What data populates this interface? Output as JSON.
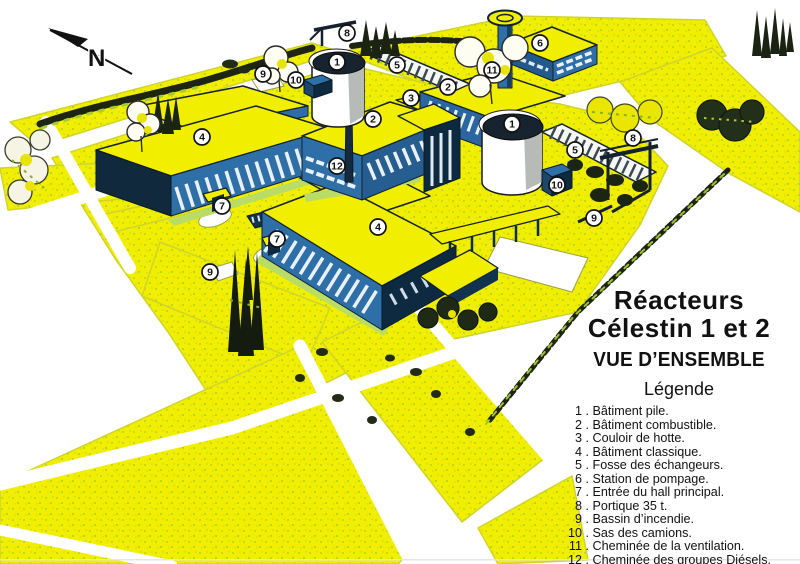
{
  "north": {
    "label": "N"
  },
  "title": {
    "line1": "Réacteurs",
    "line2": "Célestin 1 et 2",
    "subtitle": "VUE D’ENSEMBLE"
  },
  "legend": {
    "heading": "Légende",
    "separator": " . ",
    "items": [
      {
        "n": "1",
        "label": "Bâtiment pile."
      },
      {
        "n": "2",
        "label": "Bâtiment combustible."
      },
      {
        "n": "3",
        "label": "Couloir de hotte."
      },
      {
        "n": "4",
        "label": "Bâtiment classique."
      },
      {
        "n": "5",
        "label": "Fosse des échangeurs."
      },
      {
        "n": "6",
        "label": "Station de pompage."
      },
      {
        "n": "7",
        "label": "Entrée du hall principal."
      },
      {
        "n": "8",
        "label": "Portique 35 t."
      },
      {
        "n": "9",
        "label": "Bassin d’incendie."
      },
      {
        "n": "10",
        "label": "Sas des camions."
      },
      {
        "n": "11",
        "label": "Cheminée de la ventilation."
      },
      {
        "n": "12",
        "label": "Cheminée des groupes Diésels."
      }
    ]
  },
  "markers": {
    "style": {
      "fill": "#ffffff",
      "stroke": "#111111",
      "text": "#111111",
      "radius": 8
    },
    "points": [
      {
        "n": "1",
        "x": 337,
        "y": 62
      },
      {
        "n": "1",
        "x": 512,
        "y": 124
      },
      {
        "n": "2",
        "x": 448,
        "y": 87
      },
      {
        "n": "2",
        "x": 373,
        "y": 119
      },
      {
        "n": "3",
        "x": 411,
        "y": 98
      },
      {
        "n": "4",
        "x": 202,
        "y": 137
      },
      {
        "n": "4",
        "x": 378,
        "y": 227
      },
      {
        "n": "5",
        "x": 397,
        "y": 65
      },
      {
        "n": "5",
        "x": 575,
        "y": 150
      },
      {
        "n": "6",
        "x": 540,
        "y": 43
      },
      {
        "n": "7",
        "x": 222,
        "y": 206
      },
      {
        "n": "7",
        "x": 277,
        "y": 239
      },
      {
        "n": "8",
        "x": 347,
        "y": 33
      },
      {
        "n": "8",
        "x": 633,
        "y": 138
      },
      {
        "n": "9",
        "x": 263,
        "y": 74
      },
      {
        "n": "9",
        "x": 210,
        "y": 272
      },
      {
        "n": "9",
        "x": 594,
        "y": 218
      },
      {
        "n": "10",
        "x": 296,
        "y": 80
      },
      {
        "n": "10",
        "x": 557,
        "y": 185
      },
      {
        "n": "11",
        "x": 492,
        "y": 70
      },
      {
        "n": "12",
        "x": 337,
        "y": 166
      }
    ]
  },
  "colors": {
    "grass_yellow": "#f2ee00",
    "speckle_green": "#8bc723",
    "wall_blue": "#2f6fa8",
    "dark_navy": "#0e2a40",
    "tree_dark": "#1c2413",
    "paper": "#ffffff",
    "ink": "#111111"
  }
}
